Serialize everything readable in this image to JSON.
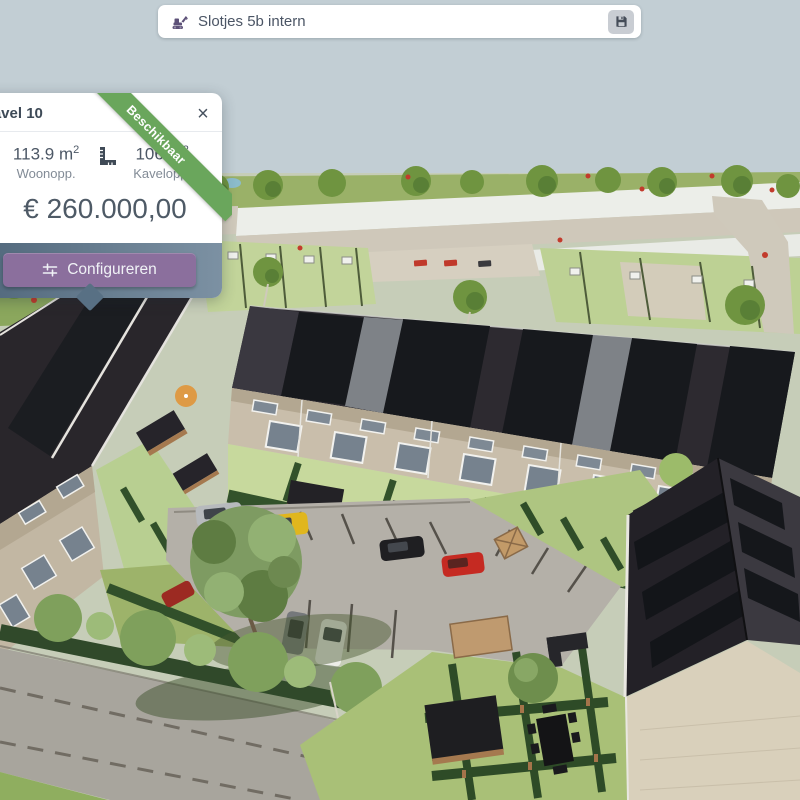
{
  "topbar": {
    "title": "Slotjes 5b intern",
    "icons": {
      "project": "excavator-icon",
      "save": "floppy-disk-icon"
    }
  },
  "kavel_card": {
    "title": "Kavel 10",
    "status_ribbon": "Beschikbaar",
    "close_glyph": "×",
    "metrics": [
      {
        "value": "113.9",
        "unit": "m",
        "unit_sup": "2",
        "label": "Woonopp."
      },
      {
        "value": "106",
        "unit": "m",
        "unit_sup": "2",
        "label": "Kavelopp."
      }
    ],
    "price": "€ 260.000,00",
    "configure_button": {
      "label": "Configureren",
      "icon": "sliders-icon"
    }
  },
  "scene": {
    "type": "3d-aerial-render",
    "description": "Aerial 3D render of a new-build housing project: terraced houses with dark solar-panel roofs, back gardens with hedges and sheds, a central parking court with parked cars, trees and a flat site plan in the background",
    "parked_car_colors": [
      "silver",
      "yellow",
      "black",
      "red",
      "gray",
      "white"
    ]
  },
  "colors": {
    "sky": "#c2ced4",
    "ribbon_green": "#6aa65c",
    "button_purple": "#8b6f9d",
    "footer_left": "#4e6579",
    "footer_right": "#7c91a3",
    "card_bg": "#ffffff",
    "text_dark": "#3e4a57",
    "text_gray": "#828b96",
    "accent_purple": "#5d5178",
    "save_button_bg": "#c9cdd3"
  }
}
